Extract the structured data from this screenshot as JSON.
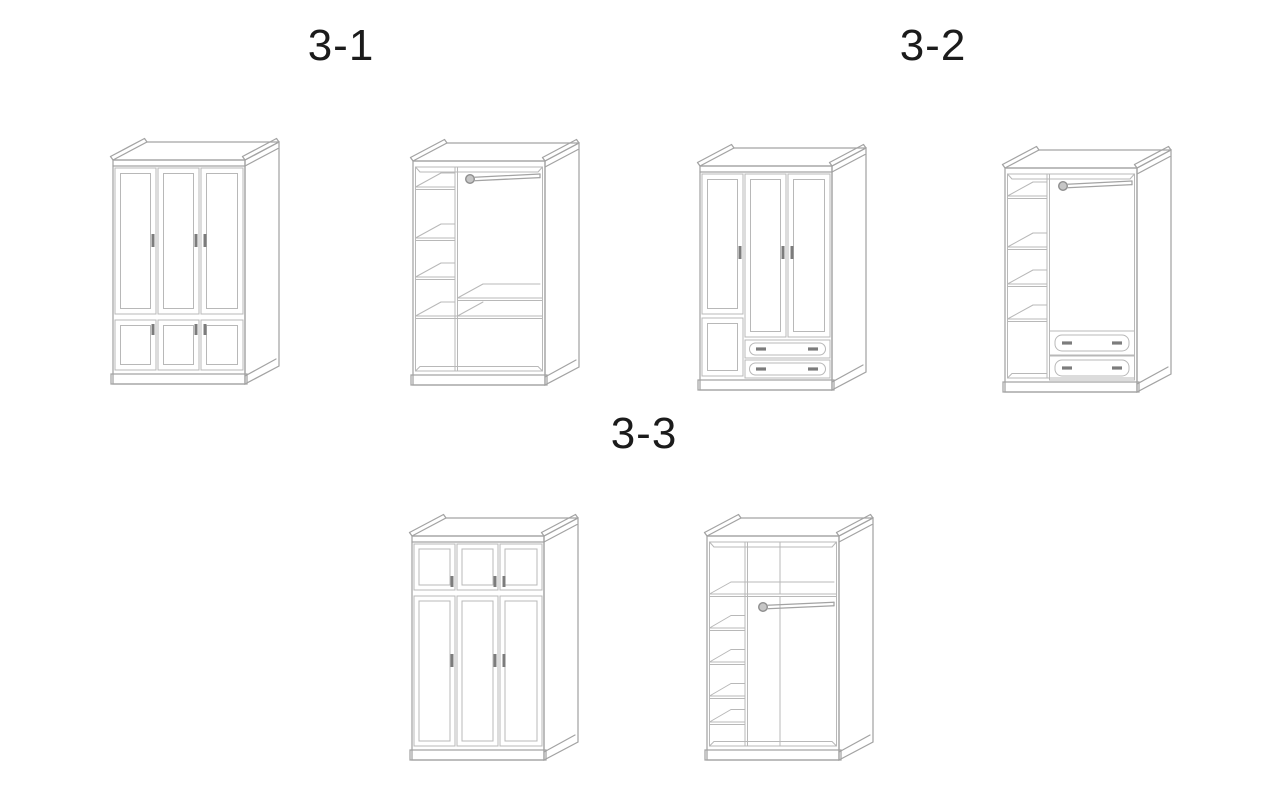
{
  "canvas": {
    "width": 1280,
    "height": 800,
    "background": "#ffffff"
  },
  "palette": {
    "outline": "#a3a3a3",
    "detail": "#b8b8b8",
    "handle": "#7c7c7c",
    "label_text": "#1b1b1b"
  },
  "sections": [
    {
      "label": "3-1",
      "views": [
        {
          "name": "wardrobe-3-1-closed",
          "description": "Closed three-door wardrobe: three tall framed doors above three small framed doors"
        },
        {
          "name": "wardrobe-3-1-open",
          "description": "Open wardrobe interior: left shelf column, clothes hanging rod, lower shelves"
        }
      ]
    },
    {
      "label": "3-2",
      "views": [
        {
          "name": "wardrobe-3-2-closed",
          "description": "Closed three-door wardrobe: small lower-left door and two bottom drawers with oval handle plates"
        },
        {
          "name": "wardrobe-3-2-open",
          "description": "Open wardrobe interior: left shelf column, clothes hanging rod, two bottom drawers"
        }
      ]
    },
    {
      "label": "3-3",
      "views": [
        {
          "name": "wardrobe-3-3-closed",
          "description": "Closed three-door wardrobe: three small top doors above three tall framed doors"
        },
        {
          "name": "wardrobe-3-3-open",
          "description": "Open wardrobe interior: left shelf column, full-width top shelf and clothes hanging rod"
        }
      ]
    }
  ]
}
